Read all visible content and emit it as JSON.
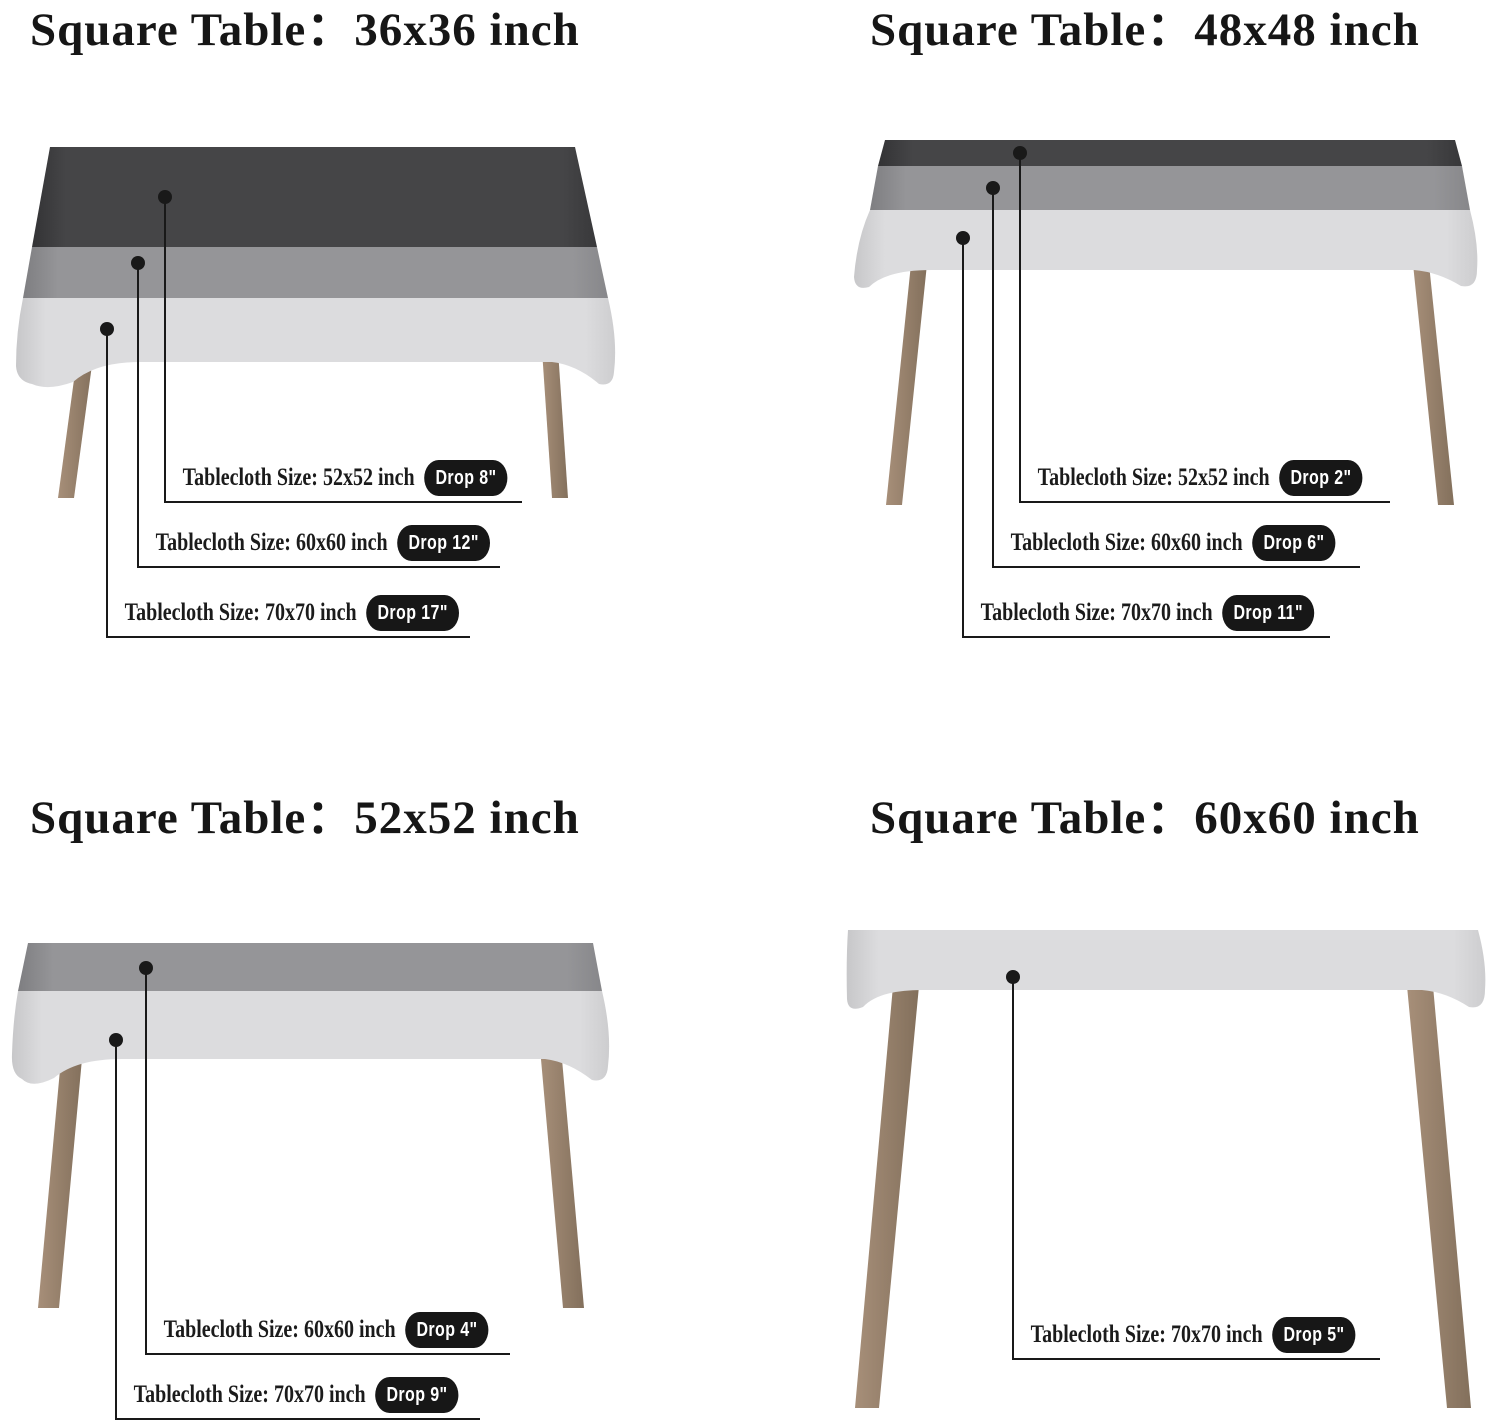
{
  "colors": {
    "background": "#ffffff",
    "cloth_dark": "#454547",
    "cloth_medium": "#959598",
    "cloth_light": "#dcdcde",
    "table_leg": "#9c8672",
    "callout_line": "#191919",
    "badge_background": "#171717",
    "badge_text": "#ffffff",
    "title_text": "#161616"
  },
  "quadrants": [
    {
      "id": "top-left",
      "title": "Square Table：36x36 inch",
      "table_size": "36x36 inch",
      "callouts": [
        {
          "label": "Tablecloth Size: 52x52 inch",
          "drop": "Drop 8\""
        },
        {
          "label": "Tablecloth Size: 60x60 inch",
          "drop": "Drop 12\""
        },
        {
          "label": "Tablecloth Size: 70x70 inch",
          "drop": "Drop 17\""
        }
      ]
    },
    {
      "id": "top-right",
      "title": "Square Table：48x48 inch",
      "table_size": "48x48 inch",
      "callouts": [
        {
          "label": "Tablecloth Size: 52x52 inch",
          "drop": "Drop 2\""
        },
        {
          "label": "Tablecloth Size: 60x60 inch",
          "drop": "Drop 6\""
        },
        {
          "label": "Tablecloth Size: 70x70 inch",
          "drop": "Drop 11\""
        }
      ]
    },
    {
      "id": "bottom-left",
      "title": "Square Table：52x52 inch",
      "table_size": "52x52 inch",
      "callouts": [
        {
          "label": "Tablecloth Size: 60x60 inch",
          "drop": "Drop 4\""
        },
        {
          "label": "Tablecloth Size: 70x70 inch",
          "drop": "Drop 9\""
        }
      ]
    },
    {
      "id": "bottom-right",
      "title": "Square Table：60x60 inch",
      "table_size": "60x60 inch",
      "callouts": [
        {
          "label": "Tablecloth Size: 70x70 inch",
          "drop": "Drop 5\""
        }
      ]
    }
  ]
}
